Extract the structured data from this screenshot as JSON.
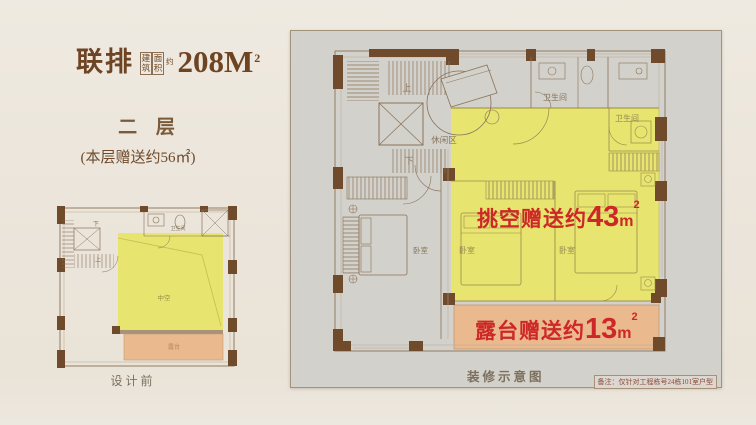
{
  "header": {
    "product": "联排",
    "area_small_1": "建筑",
    "area_small_2": "面积",
    "area_small_3": "约",
    "area_number": "208M",
    "area_sup": "2",
    "floor": "二 层",
    "bonus": "(本层赠送约56㎡)"
  },
  "left_plan": {
    "caption": "设计前",
    "void_label": "中空",
    "terrace_label": "露台",
    "bath": "卫生间",
    "up": "上",
    "down": "下"
  },
  "right_plan": {
    "void_bonus": {
      "label": "挑空赠送约",
      "num": "43",
      "unit": "m",
      "sup": "2"
    },
    "terrace_bonus": {
      "label": "露台赠送约",
      "num": "13",
      "unit": "m",
      "sup": "2"
    },
    "caption": "装修示意图",
    "disclaimer": "备注：仅针对工程栋号24栋101室户型",
    "leisure": "休闲区",
    "bath1": "卫生间",
    "bath2": "卫生间",
    "bedroom1": "卧室",
    "bedroom2": "卧室",
    "bedroom3": "卧室",
    "up": "上",
    "down": "下"
  },
  "colors": {
    "background": "#ebe5dc",
    "panel_gray": "#d3d1cb",
    "wall_brown": "#6f4b2c",
    "line_brown": "#8a7258",
    "highlight_yellow": "#e7e46f",
    "highlight_orange": "#eab98e",
    "accent_red": "#cd2727",
    "title_brown": "#6e4423"
  }
}
